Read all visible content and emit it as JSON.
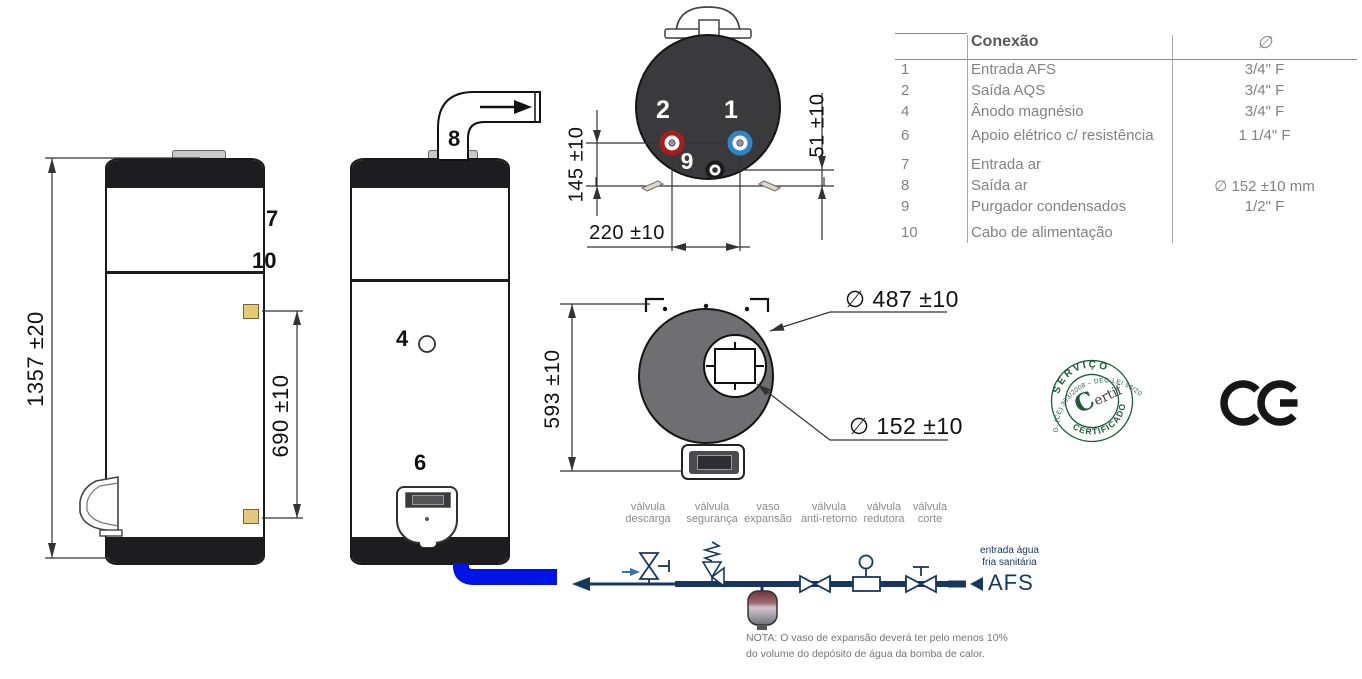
{
  "side_view": {
    "height_dim": "1357 ±20",
    "bracket_dim": "690 ±10",
    "callout_air_inlet": "7",
    "callout_power_cable": "10"
  },
  "front_view": {
    "callout_air_outlet": "8",
    "callout_anode": "4",
    "callout_electric_heater": "6"
  },
  "bottom_view": {
    "callout_cold_inlet": "1",
    "callout_hot_outlet": "2",
    "callout_condensate": "9",
    "dim_connections_height": "145 ±10",
    "dim_condensate_height": "51 ±10",
    "dim_connections_spacing": "220 ±10"
  },
  "top_view": {
    "dim_depth": "593 ±10",
    "dim_outer_diameter": "∅ 487 ±10",
    "dim_duct_diameter": "∅ 152 ±10"
  },
  "table": {
    "header": {
      "connection": "Conexão",
      "diameter": "∅"
    },
    "rows": [
      {
        "num": "1",
        "label": "Entrada AFS",
        "value": "3/4\" F"
      },
      {
        "num": "2",
        "label": "Saída AQS",
        "value": "3/4\" F"
      },
      {
        "num": "4",
        "label": "Ânodo magnésio",
        "value": "3/4\" F"
      },
      {
        "num": "6",
        "label": "Apoio elétrico c/ resistência",
        "value": "1 1/4\" F"
      },
      {
        "num": "7",
        "label": "Entrada ar",
        "value": ""
      },
      {
        "num": "8",
        "label": "Saída ar",
        "value": "∅ 152 ±10 mm"
      },
      {
        "num": "9",
        "label": "Purgador condensados",
        "value": "1/2\" F"
      },
      {
        "num": "10",
        "label": "Cabo de alimentação",
        "value": ""
      }
    ]
  },
  "schematic": {
    "components": [
      {
        "line1": "válvula",
        "line2": "descarga"
      },
      {
        "line1": "válvula",
        "line2": "segurança"
      },
      {
        "line1": "vaso",
        "line2": "expansão"
      },
      {
        "line1": "válvula",
        "line2": "anti-retorno"
      },
      {
        "line1": "válvula",
        "line2": "redutora"
      },
      {
        "line1": "válvula",
        "line2": "corte"
      }
    ],
    "inlet_label_line1": "entrada água",
    "inlet_label_line2": "fria sanitária",
    "afs_label": "AFS",
    "note_line1": "NOTA: O vaso de expansão deverá ter pelo menos 10%",
    "note_line2": "do volume do depósito de água da bomba de calor."
  },
  "certification": {
    "seal_top": "SERVIÇO",
    "seal_bottom": "CERTIFICADO",
    "seal_outer": "REG. (CE) 303/2008 – DEC-LEI 56/2011",
    "logo_initial": "C",
    "logo_suffix": "ertif",
    "ce_label": "CE"
  },
  "colors": {
    "accent_navy": "#17375e",
    "pipe_blue": "#0013e6",
    "tank_dark_view": "#3a3a3c",
    "top_view_gray": "#6f6f71",
    "seal_green": "#1d5b38",
    "connection_red": "#a81c1c",
    "connection_blue": "#2d85c5",
    "bracket_yellow": "#e7c87a"
  }
}
